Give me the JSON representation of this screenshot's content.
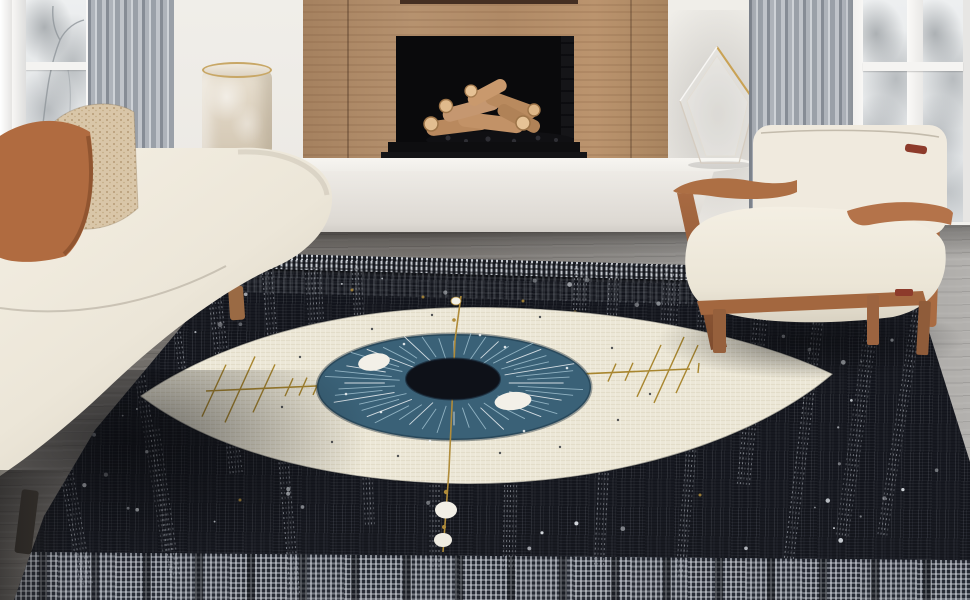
{
  "scene": {
    "label": "Living room with a black evil-eye area rug, cream sofa, oak-frame armchair, wood-paneled fireplace and snowy windows"
  },
  "objects": {
    "window_left": {
      "label": "Window with snowy trees (left)"
    },
    "curtain_left": {
      "label": "Sheer gray curtain (left)"
    },
    "fireplace": {
      "label": "Wood-paneled fireplace with stacked firewood logs"
    },
    "bench": {
      "label": "White floating hearth bench"
    },
    "vase": {
      "label": "Cream frosted cylinder vase with gold rim"
    },
    "sculpture": {
      "label": "Clear glass prism sculpture"
    },
    "curtain_right": {
      "label": "Sheer gray curtain (right)"
    },
    "window_right": {
      "label": "Window with snowy trees (right)"
    },
    "floor": {
      "label": "Gray wood plank floor"
    },
    "sofa": {
      "label": "Cream sofa with rust and beige speckled pillows"
    },
    "armchair": {
      "label": "Cream cushioned armchair with warm oak frame"
    },
    "rug": {
      "label": "Black woven area rug with large eye motif"
    }
  },
  "rug_design": {
    "motif": "eye",
    "field_color": "#14161d",
    "eye_cream": "#ece7d7",
    "iris_blue": "#3a6177",
    "pupil_color": "#10131a",
    "gold_accent": "#b08c3a",
    "weave_dot": "#cdd2d8",
    "details": [
      "starburst iris",
      "gold crosshair with tick slashes",
      "moon-phase dots below eye",
      "scattered star dots",
      "dotted stripe columns",
      "light woven border bands"
    ]
  },
  "palette": {
    "wall": "#ece9e4",
    "wood_panel": "#b28d6d",
    "bench_white": "#f2f0ec",
    "floor_gray": "#7b7773",
    "floor_light": "#b2b0ad",
    "sofa_cream": "#f0ebdf",
    "pillow_rust": "#b06b40",
    "pillow_beige": "#d9c6a8",
    "chair_wood": "#ad6f44",
    "log_tan": "#c29267",
    "curtain_gray": "#aeb3ba"
  }
}
